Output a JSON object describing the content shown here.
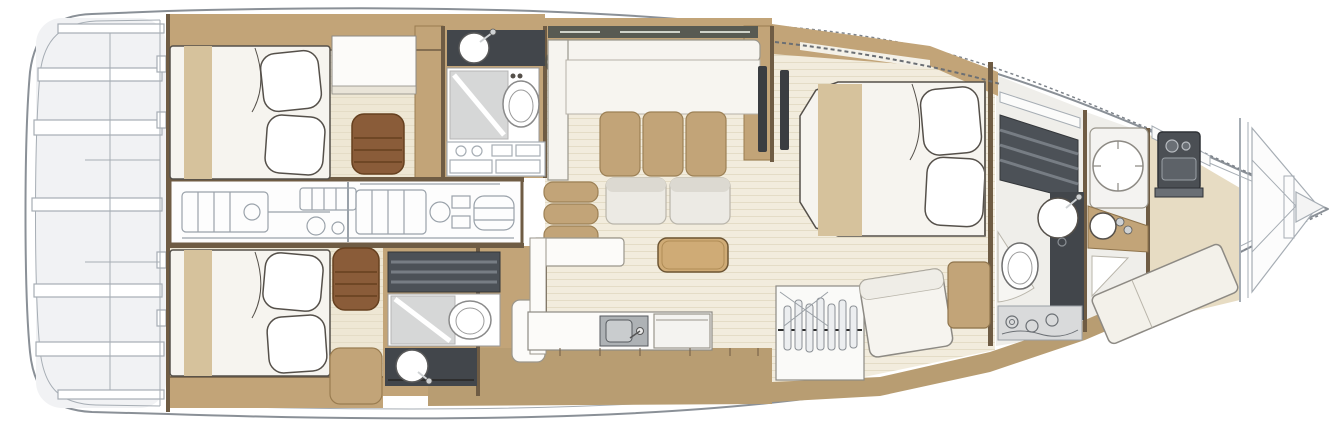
{
  "document": {
    "kind": "yacht-interior-deck-plan",
    "view": "top-down floor plan",
    "orientation": "bow-right, stern-left",
    "visible_text": ""
  },
  "colors": {
    "hull_stroke": "#8a9097",
    "stern_fill": "#f1f2f4",
    "lineart": "#a6adb4",
    "lineart_dark": "#7d838a",
    "wall_brown": "#6f5c44",
    "wood_tan": "#c2a478",
    "wood_tan_edge": "#997c50",
    "runner_tan": "#d6c29c",
    "walkway_tan": "#b89d72",
    "floor_cream": "#f2ecdd",
    "floor_cabin": "#eee7d4",
    "plank_line": "#e4dcc6",
    "floor_pale": "#efeeea",
    "furniture_white": "#f6f4ef",
    "bright_white": "#fcfbf9",
    "cushion_white": "#eceae4",
    "headrest_gray": "#dcd9d1",
    "counter_dark": "#42464b",
    "slat_dark": "#4c5157",
    "slat_light": "#777d84",
    "shower_gray": "#d6d7d7",
    "leather_brown": "#8a5c39",
    "leather_dark": "#66401f",
    "window_dark": "#585a52",
    "machinery_gray": "#9aa2aa",
    "table_wood": "#cfab76",
    "outline_dark": "#55504a"
  },
  "rooms": {
    "swim_platform": {
      "label": "Stern swim platform and tender garage with steps"
    },
    "aft_cabin_port": {
      "label": "Aft guest cabin (upper) with double bed, desk and leather pouf"
    },
    "aft_head_port": {
      "label": "Upper guest bathroom with washbasin, shower and toilet"
    },
    "engine_room": {
      "label": "Engine room machinery (technical line drawing)"
    },
    "aft_cabin_stbd": {
      "label": "Aft guest cabin (lower) with double bed and drawer pouf"
    },
    "aft_head_stbd": {
      "label": "Lower guest bathroom with shower, toilet and washbasin"
    },
    "salon": {
      "label": "Main salon with L-shaped sofa, lounge chairs, bench and coffee table"
    },
    "galley": {
      "label": "Galley counter with sink and appliance"
    },
    "master_cabin": {
      "label": "Master cabin with island double bed, hanging wardrobe and chaise"
    },
    "master_head": {
      "label": "Forward master bathroom with washbasin and toilet"
    },
    "fwd_shower": {
      "label": "Forward shower room with rain shower and washbasin"
    },
    "forepeak": {
      "label": "Forepeak with berth and anchor windlass"
    },
    "bow": {
      "label": "Bow with anchor locker"
    }
  }
}
